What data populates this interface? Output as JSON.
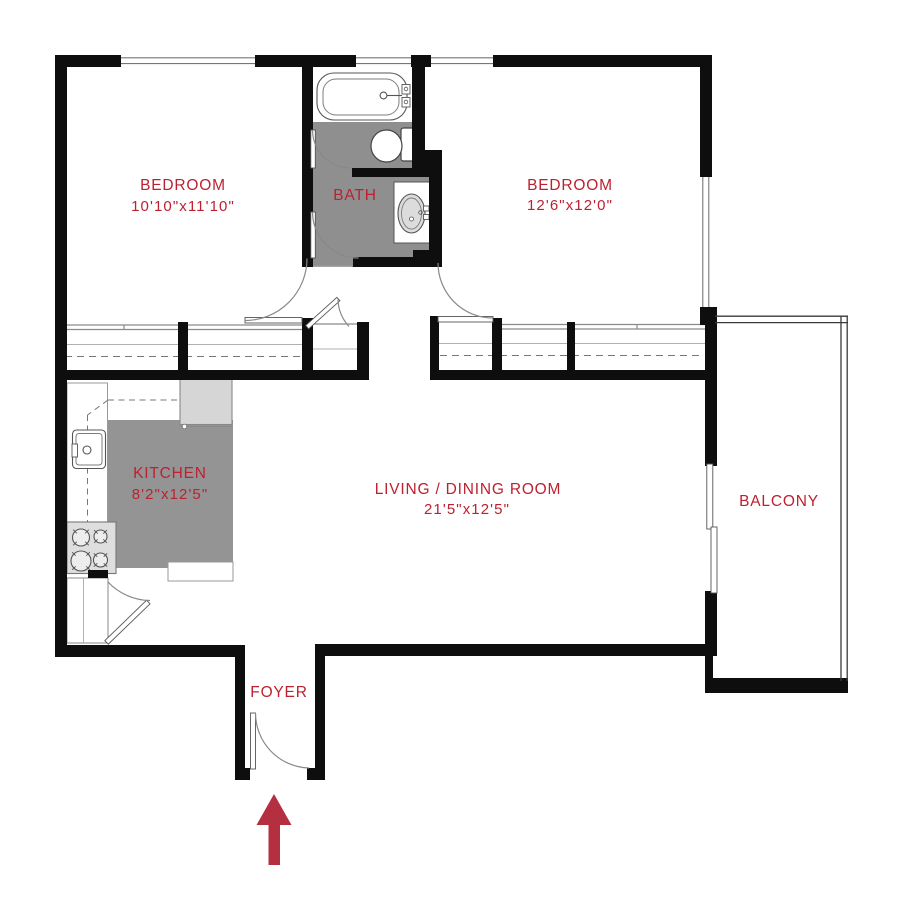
{
  "plan_title": "2 Bedroom Apartment Floor Plan",
  "accent_color": "#bd2130",
  "arrow_color": "#b43040",
  "wall_color": "#0e0e0e",
  "floor_gray": "#8f8f8f",
  "entry": {
    "arrow_direction": "up",
    "location": "foyer"
  },
  "fixtures": [
    "bathtub",
    "toilet",
    "vanity-sink",
    "kitchen-sink",
    "stove",
    "refrigerator",
    "closets",
    "sliding-balcony-door"
  ],
  "rooms": {
    "bedroom1": {
      "name": "BEDROOM",
      "dims": "10'10\"x11'10\""
    },
    "bedroom2": {
      "name": "BEDROOM",
      "dims": "12'6\"x12'0\""
    },
    "bath": {
      "name": "BATH"
    },
    "kitchen": {
      "name": "KITCHEN",
      "dims": "8'2\"x12'5\""
    },
    "living": {
      "name": "LIVING / DINING ROOM",
      "dims": "21'5\"x12'5\""
    },
    "balcony": {
      "name": "BALCONY"
    },
    "foyer": {
      "name": "FOYER"
    }
  }
}
